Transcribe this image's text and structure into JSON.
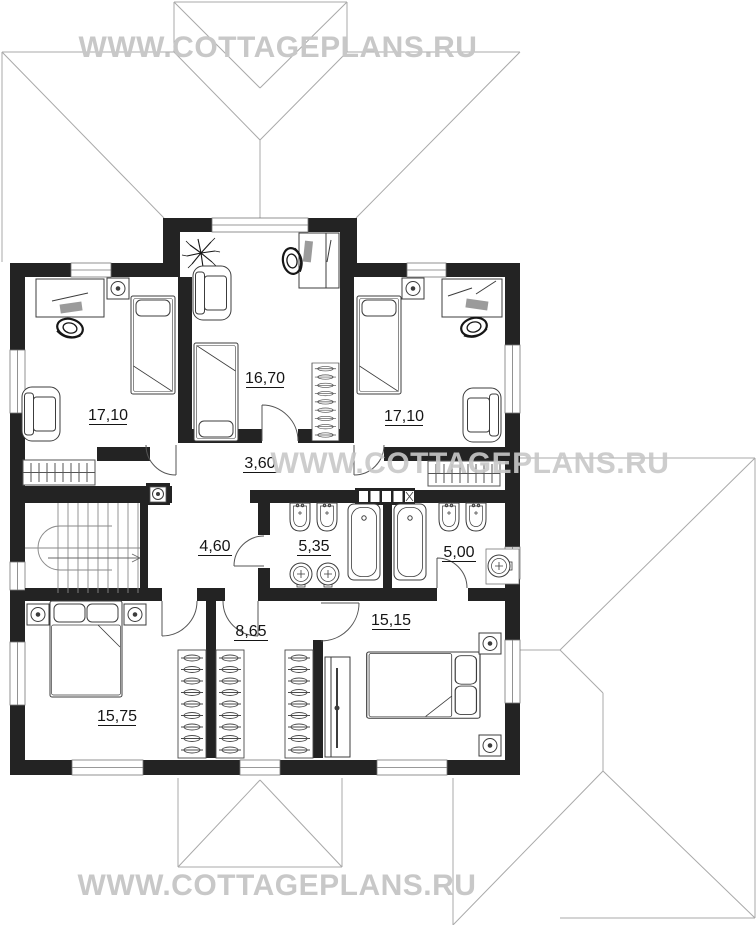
{
  "watermark": {
    "text": "WWW.COTTAGEPLANS.RU",
    "color": "#c8c8c8"
  },
  "plan": {
    "type": "floor-plan",
    "units": "m2",
    "wall_color": "#232323",
    "rooms": {
      "top_left_bedroom": {
        "name": "bedroom-top-left",
        "area": "17,10"
      },
      "top_center_bedroom": {
        "name": "bedroom-top-center",
        "area": "16,70"
      },
      "top_right_bedroom": {
        "name": "bedroom-top-right",
        "area": "17,10"
      },
      "corridor": {
        "name": "corridor",
        "area": "3,60"
      },
      "hall": {
        "name": "stair-hall",
        "area": "4,60"
      },
      "bathroom_left": {
        "name": "bathroom-left",
        "area": "5,35"
      },
      "bathroom_right": {
        "name": "bathroom-right",
        "area": "5,00"
      },
      "bottom_left_bedroom": {
        "name": "bedroom-bottom-left",
        "area": "15,75"
      },
      "wardrobe_room": {
        "name": "walk-in-closet",
        "area": "8,65"
      },
      "bottom_right_bedroom": {
        "name": "bedroom-bottom-right",
        "area": "15,15"
      }
    }
  }
}
